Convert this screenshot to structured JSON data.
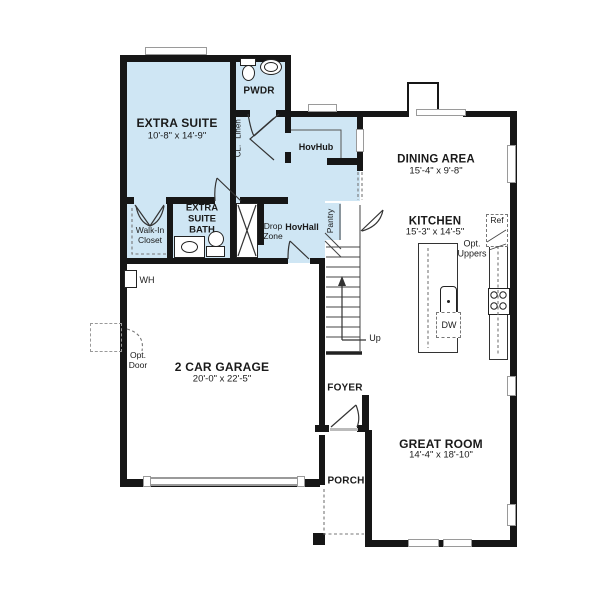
{
  "plan": {
    "rooms": {
      "extra_suite": {
        "name": "EXTRA SUITE",
        "dims": "10'-8\" x 14'-9\""
      },
      "pwdr": {
        "name": "PWDR"
      },
      "hovhub": {
        "name": "HovHub"
      },
      "dining_area": {
        "name": "DINING AREA",
        "dims": "15'-4\" x 9'-8\""
      },
      "kitchen": {
        "name": "KITCHEN",
        "dims": "15'-3\" x 14'-5\""
      },
      "extra_suite_bath": {
        "name": "EXTRA SUITE BATH"
      },
      "walk_in_closet": {
        "name": "Walk-In Closet"
      },
      "drop_zone": {
        "name": "Drop Zone"
      },
      "hovhall": {
        "name": "HovHall"
      },
      "pantry": {
        "name": "Pantry"
      },
      "cl": {
        "name": "CL."
      },
      "linen": {
        "name": "Linen"
      },
      "garage": {
        "name": "2 CAR GARAGE",
        "dims": "20'-0\" x 22'-5\""
      },
      "foyer": {
        "name": "FOYER"
      },
      "great_room": {
        "name": "GREAT ROOM",
        "dims": "14'-4\" x 18'-10\""
      },
      "porch": {
        "name": "PORCH"
      }
    },
    "annotations": {
      "wh": "WH",
      "up": "Up",
      "ref": "Ref",
      "dw": "DW",
      "opt_door": "Opt. Door",
      "opt_uppers": "Opt. Uppers"
    },
    "colors": {
      "suite_fill": "#cfe6f4",
      "wall": "#161616",
      "window_frame": "#9a9a9a",
      "thin_line": "#333333"
    }
  }
}
